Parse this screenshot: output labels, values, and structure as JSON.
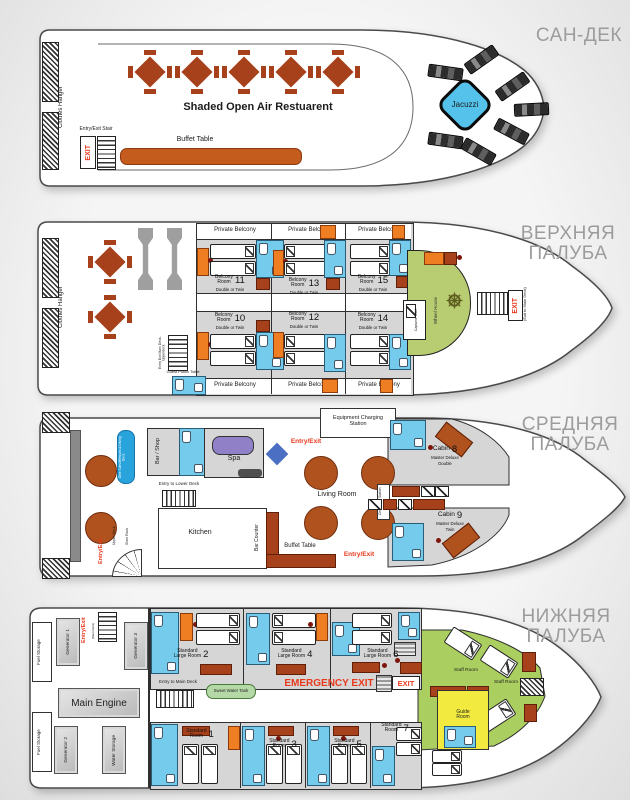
{
  "deck_sun": {
    "title": "САН-ДЕК",
    "clothes_hanger": "Clothes Hanger",
    "entry_exit_stair": "Entry/Exit Stair",
    "exit": "EXIT",
    "restaurant": "Shaded Open Air Restuarent",
    "buffet_table": "Buffet Table",
    "jacuzzi": "Jacuzzi"
  },
  "deck_upper": {
    "title_line1": "ВЕРХНЯЯ",
    "title_line2": "ПАЛУБА",
    "clothes_hanger": "Clothes Hanger",
    "private_balcony": "Private Belcony",
    "stair_label": "Entry Exit Main Deck-Upperdeck",
    "guest_toilet": "Guest Public Toilet",
    "captains_toilet": "Captains Toilet",
    "wheel_house": "Wheel House",
    "exit": "EXIT",
    "exit_sub": "(Exit to Main Deck)",
    "room_l1": "Belcony",
    "room_l2": "Room",
    "room_sub": "Double or Twin",
    "rooms": {
      "r10": "10",
      "r11": "11",
      "r12": "12",
      "r13": "13",
      "r14": "14",
      "r15": "15"
    }
  },
  "deck_middle": {
    "title_line1": "СРЕДНЯЯ",
    "title_line2": "ПАЛУБА",
    "dive_l1": "Dive Suits/Wetsuits &",
    "dive_l2": "Diving Deck",
    "entry_exit": "Entry/Exit",
    "upper_deck": "Upper Deck",
    "shoe_rack": "Shoe Rack",
    "bar_shop": "Bar / Shop",
    "spa": "Spa",
    "equipment_l1": "Equipment Charging",
    "equipment_l2": "Station",
    "living_room": "Living Room",
    "kitchen": "Kitchen",
    "entry_lower": "Entry to Lower Deck",
    "bar_counter": "Bar Counter",
    "buffet_table": "Buffet Table",
    "central_tv": "Central T.V Station",
    "cabin": "Cabin",
    "cabin8": {
      "num": "8",
      "sub1": "Master Deluxe",
      "sub2": "Double"
    },
    "cabin9": {
      "num": "9",
      "sub1": "Master Deluxe",
      "sub2": "Twin"
    }
  },
  "deck_lower": {
    "title_line1": "НИЖНЯЯ",
    "title_line2": "ПАЛУБА",
    "fuel_storage": "Fuel Storage",
    "generator1": "Generator 1",
    "generator2": "Generator 2",
    "generator3": "Generator 3",
    "water_storage": "Water Storage",
    "main_engine": "Main Engine",
    "entry_exit": "Entry/Exit",
    "entry_exit_sub": "(Main Deck)",
    "entry_main_deck": "Entry to Main Deck",
    "sweet_water": "Sweet Water Tank",
    "emergency_exit": "EMERGENCY EXIT",
    "exit": "EXIT",
    "std_l1": "Standard",
    "std_large_l2": "Large Room",
    "std_l2": "Room",
    "rooms": {
      "r1": "1",
      "r2": "2",
      "r3": "3",
      "r4": "4",
      "r5": "5",
      "r6": "6",
      "r7": "7"
    },
    "staff_room": "Staff Room",
    "guide_l1": "Guide",
    "guide_l2": "Room"
  }
}
